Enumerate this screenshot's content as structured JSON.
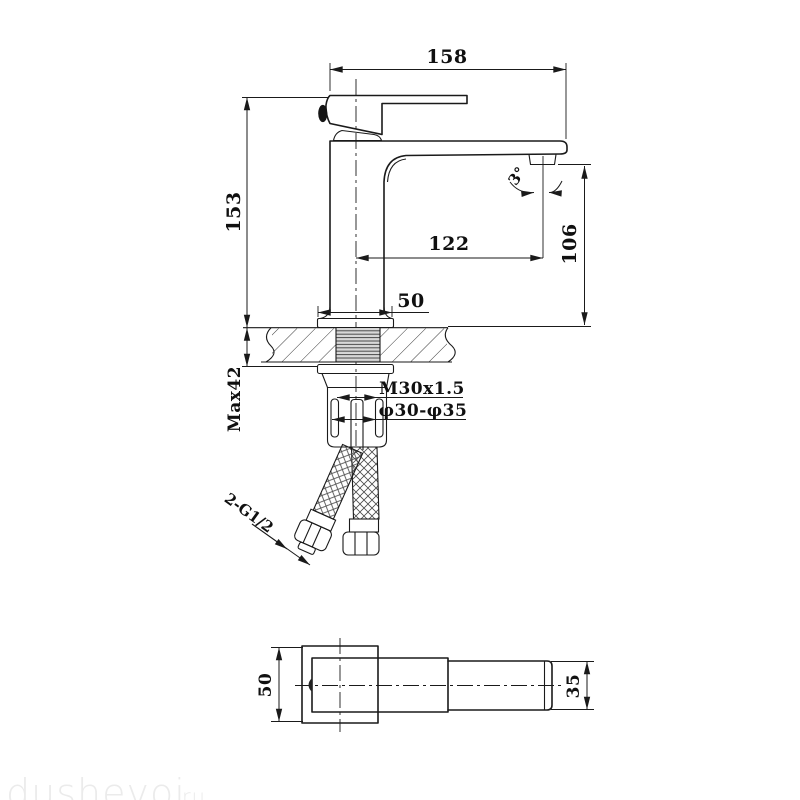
{
  "colors": {
    "line": "#1a1a1a",
    "thread_fill": "#d8d8d8",
    "hatch": "#3a3a3a",
    "watermark": "#ebebeb"
  },
  "front_view": {
    "dim_total_width": "158",
    "dim_total_height": "153",
    "dim_spout_reach": "122",
    "dim_spout_height": "106",
    "dim_base_width": "50",
    "dim_max_deck_thickness": "Max42",
    "label_mounting_thread": "M30x1.5",
    "label_hole_diameter": "φ30-φ35",
    "label_hose_connection": "2-G1/2",
    "label_swivel_angle": "3°"
  },
  "plan_view": {
    "dim_body_width": "50",
    "dim_handle_width": "35"
  },
  "watermark": {
    "text": "dushevoi",
    "suffix": "ru"
  }
}
